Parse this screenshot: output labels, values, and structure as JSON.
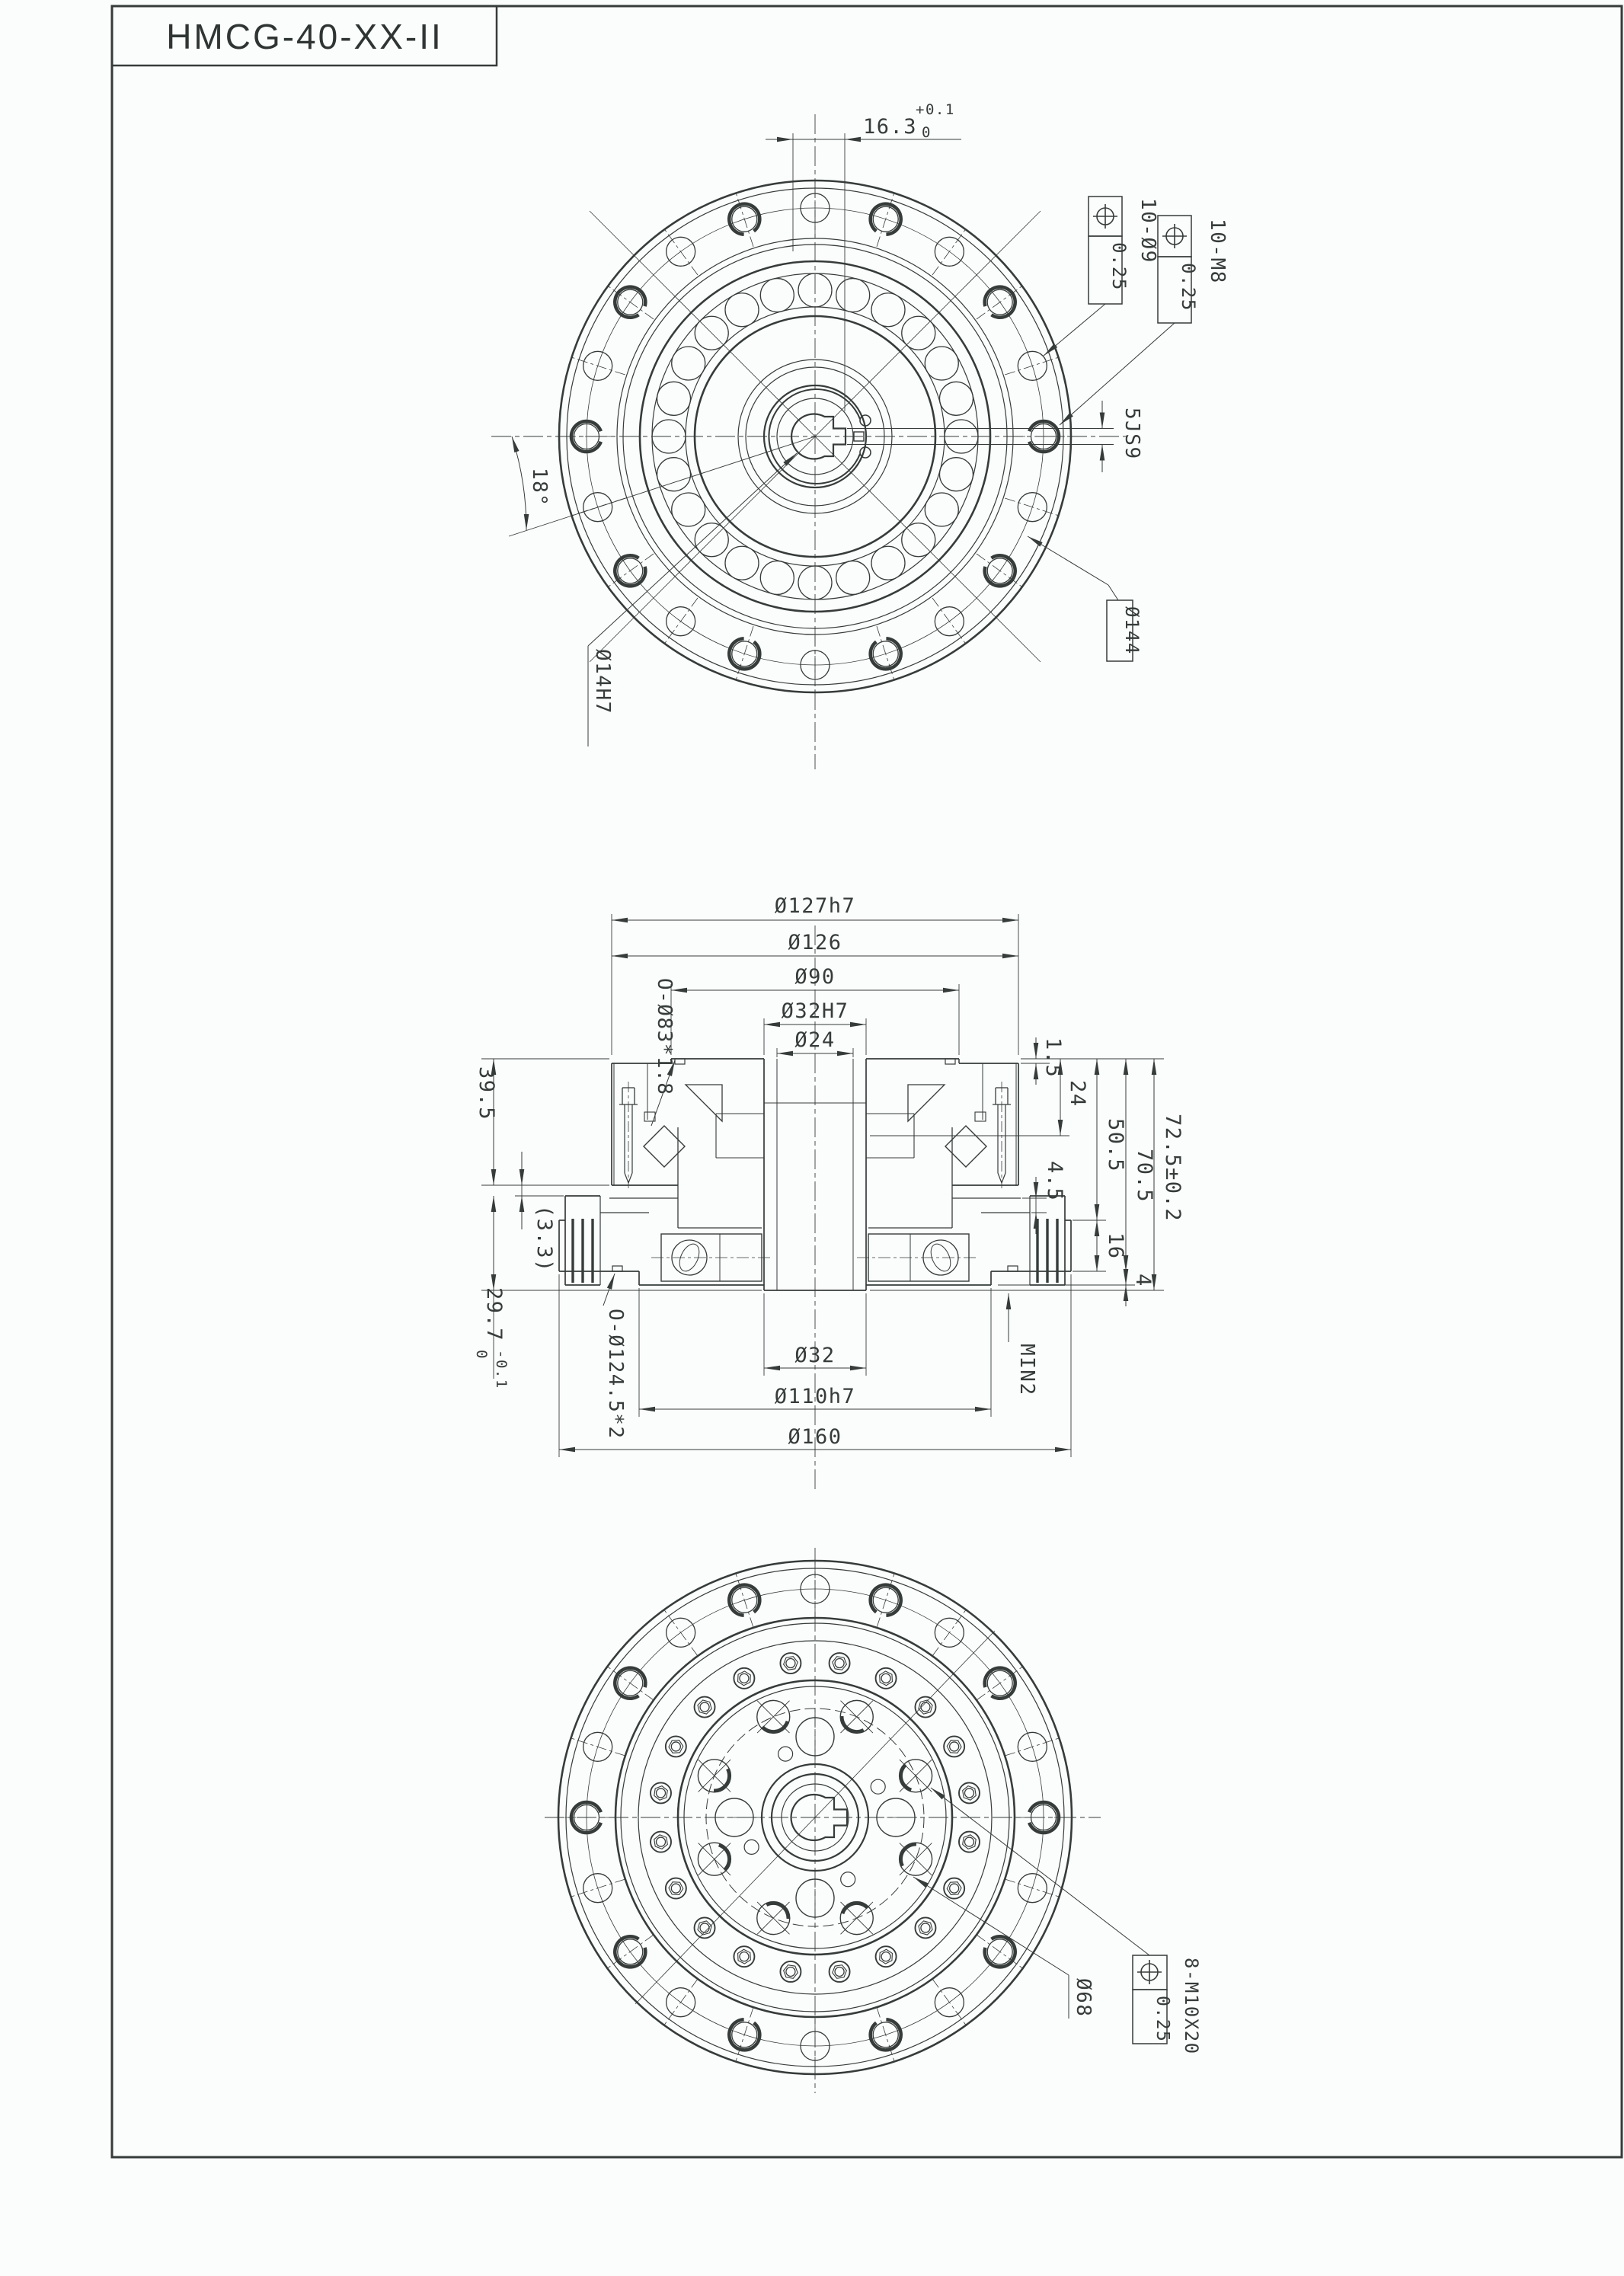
{
  "title": "HMCG-40-XX-II",
  "top_view": {
    "keyway_dim": "16.3",
    "keyway_tol_upper": "+0.1",
    "keyway_tol_lower": "0",
    "holes_label": "10-Ø9",
    "holes_tol": "0.25",
    "taps_label": "10-M8",
    "taps_tol": "0.25",
    "key_slot": "5JS9",
    "bolt_circle": "Ø144",
    "angle": "18°",
    "bore": "Ø14H7"
  },
  "section_view": {
    "dia_127": "Ø127h7",
    "dia_126": "Ø126",
    "dia_90": "Ø90",
    "dia_32h": "Ø32H7",
    "dia_24": "Ø24",
    "oring_top": "O-Ø83*1.8",
    "oring_bottom": "O-Ø124.5*2",
    "h_39_5": "39.5",
    "h_3_3": "(3.3)",
    "h_29_7": "29.7",
    "h_29_7_tol_up": "0",
    "h_29_7_tol_dn": "-0.1",
    "h_1_5": "1.5",
    "h_24": "24",
    "h_50_5": "50.5",
    "h_70_5": "70.5",
    "h_72_5": "72.5±0.2",
    "h_4_5": "4.5",
    "h_16": "16",
    "h_4": "4",
    "min_gap": "MIN2",
    "dia_32": "Ø32",
    "dia_110": "Ø110h7",
    "dia_160": "Ø160"
  },
  "bottom_view": {
    "bolt_circle": "Ø68",
    "taps_label": "8-M10X20",
    "taps_tol": "0.25"
  }
}
